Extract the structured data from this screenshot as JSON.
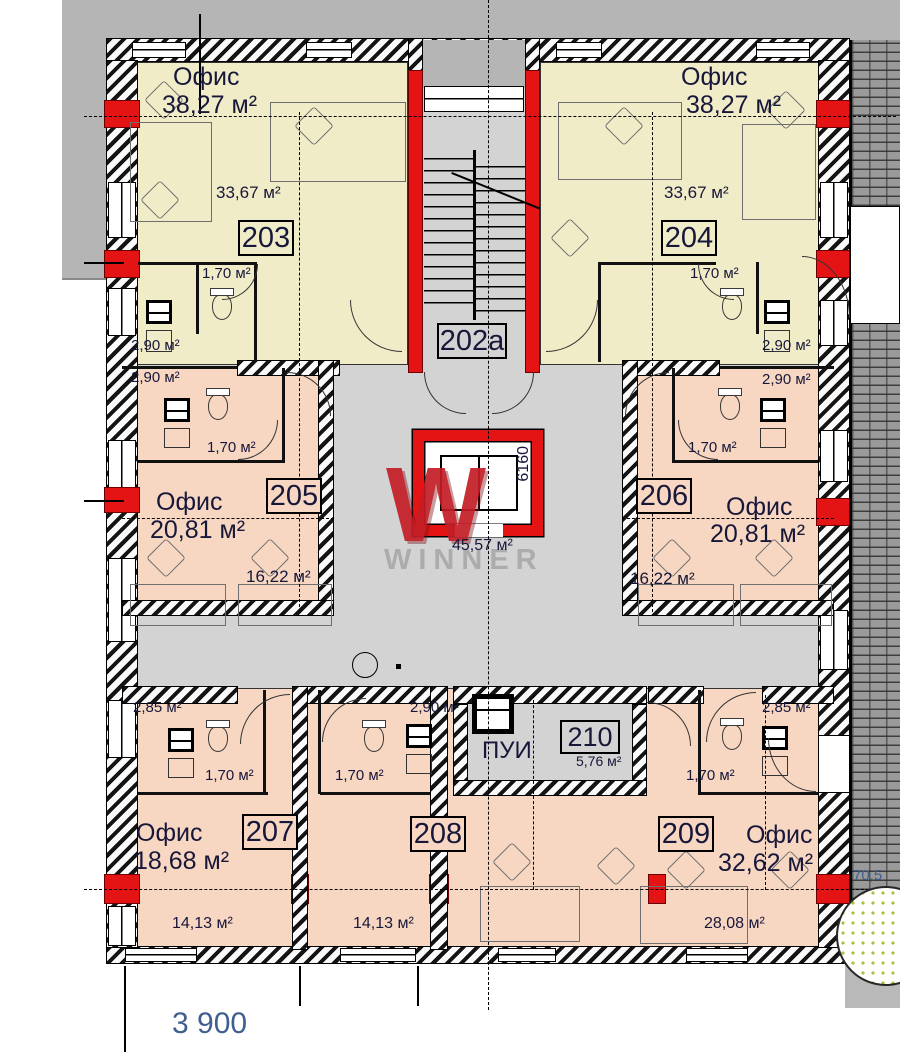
{
  "plan": {
    "rooms": [
      {
        "number": "203",
        "name": "Офис",
        "area_total": "38,27 м²",
        "area_main": "33,67 м²",
        "area_wc": "1,70 м²",
        "area_bath": "2,90 м²"
      },
      {
        "number": "204",
        "name": "Офис",
        "area_total": "38,27 м²",
        "area_main": "33,67 м²",
        "area_wc": "1,70 м²",
        "area_bath": "2,90 м²"
      },
      {
        "number": "205",
        "name": "Офис",
        "area_total": "20,81 м²",
        "area_main": "16,22 м²",
        "area_wc": "1,70 м²",
        "area_bath": "2,90 м²"
      },
      {
        "number": "206",
        "name": "Офис",
        "area_total": "20,81 м²",
        "area_main": "16,22 м²",
        "area_wc": "1,70 м²",
        "area_bath": "2,90 м²"
      },
      {
        "number": "207",
        "name": "Офис",
        "area_total": "18,68 м²",
        "area_main": "14,13 м²",
        "area_wc": "1,70 м²",
        "area_bath": "2,85 м²"
      },
      {
        "number": "208",
        "name": "",
        "area_total": "",
        "area_main": "14,13 м²",
        "area_wc": "1,70 м²",
        "area_bath": "2,90 м²"
      },
      {
        "number": "209",
        "name": "Офис",
        "area_total": "32,62 м²",
        "area_main": "28,08 м²",
        "area_wc": "1,70 м²",
        "area_bath": "2,85 м²"
      },
      {
        "number": "210",
        "name": "ПУИ",
        "area_total": "5,76 м²"
      }
    ],
    "stairwell": {
      "number": "202a"
    },
    "lobby": {
      "area": "45,57 м²"
    },
    "dims": {
      "width": "3 900",
      "shaft": "6160",
      "edge": "70,5"
    },
    "watermark": {
      "letter": "W",
      "name": "WINNER"
    },
    "colors": {
      "office_yellow": "#f1ecc8",
      "office_pink": "#f7d7c2",
      "floor_gray": "#d3d3d3",
      "outside_gray": "#b5b5b5",
      "wall_red": "#e41414"
    }
  }
}
